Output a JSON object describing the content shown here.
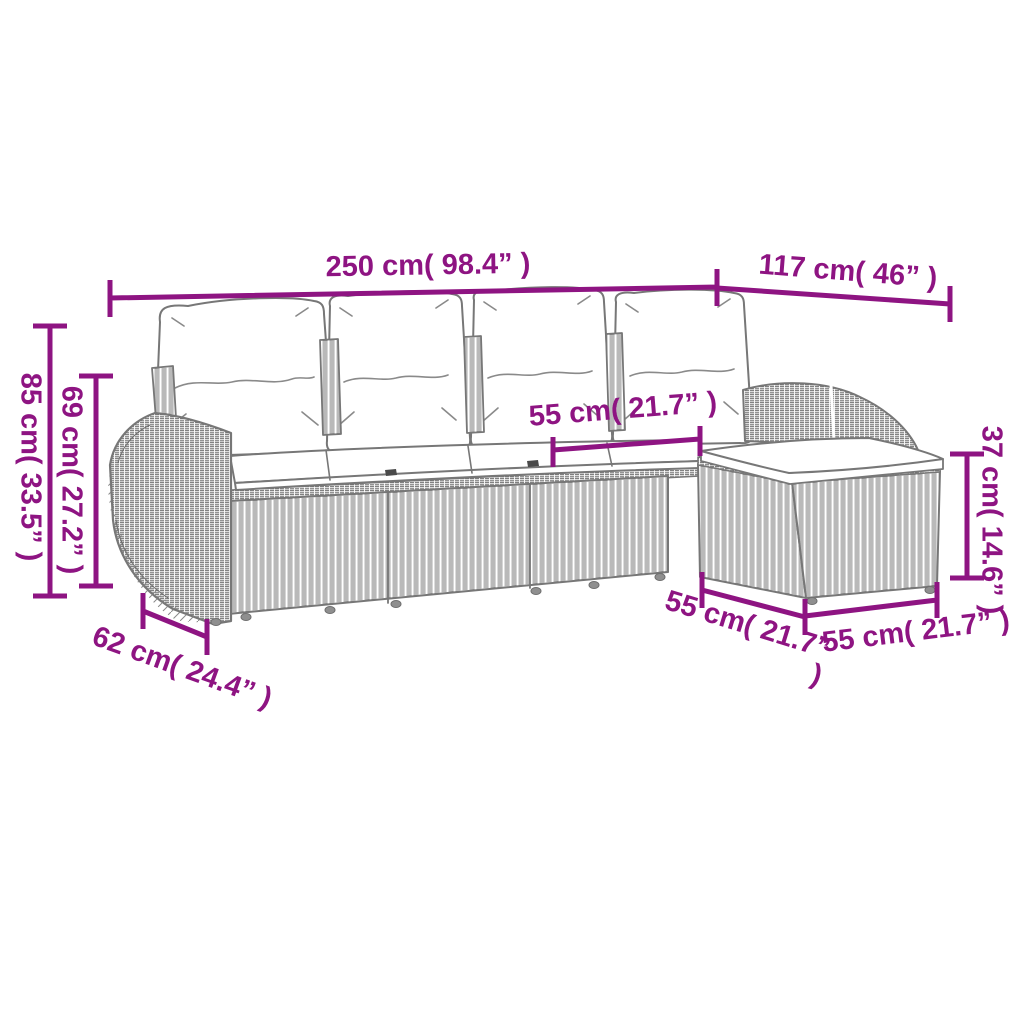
{
  "colors": {
    "accent": "#8E1482",
    "outline": "#777777",
    "background": "#ffffff"
  },
  "figure": {
    "description": "dimension diagram of 5-piece poly rattan garden lounge set with cushions and footstool"
  },
  "dimensions": {
    "total_width": "250 cm( 98.4” )",
    "total_depth": "117 cm( 46” )",
    "overall_height": "85 cm( 33.5” )",
    "backrest_height": "69 cm( 27.2” )",
    "seat_width": "55 cm( 21.7” )",
    "footstool_height": "37 cm( 14.6” )",
    "armrest_depth": "62 cm( 24.4” )",
    "corner_seat_depth": "55 cm( 21.7” )",
    "footstool_width": "55 cm( 21.7” )"
  }
}
